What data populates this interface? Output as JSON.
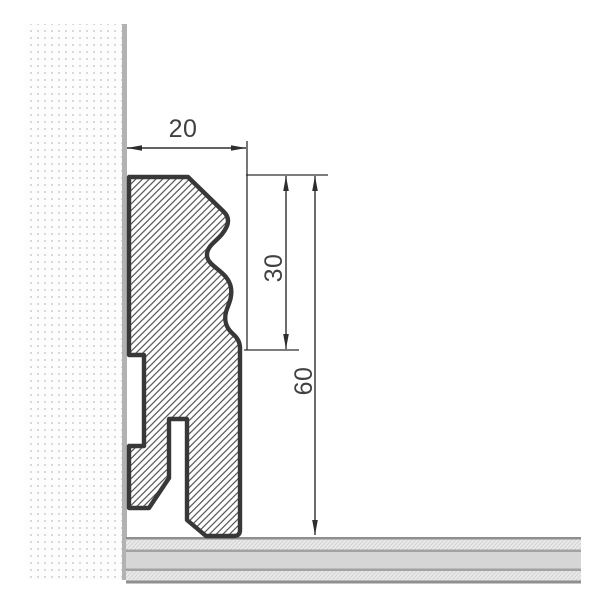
{
  "diagram": {
    "title": "skirting-board-profile-cross-section",
    "labels": {
      "width": "20",
      "upper_height": "30",
      "total_height": "60"
    },
    "colors": {
      "background": "#ffffff",
      "profile_outline": "#383838",
      "profile_hatch": "#4a4a4a",
      "dimension_line": "#2e2e2e",
      "label_text": "#414141",
      "wall_edge": "#b2b2b2",
      "wall_dot": "#d9d9d9",
      "floor_band_solid": "#d6d6d6",
      "floor_band_edge": "#a3a3a3",
      "floor_top_line": "#8f8f8f",
      "floor_hatch_bg": "#ebebeb",
      "floor_hatch_line": "#d2d2d2"
    }
  }
}
